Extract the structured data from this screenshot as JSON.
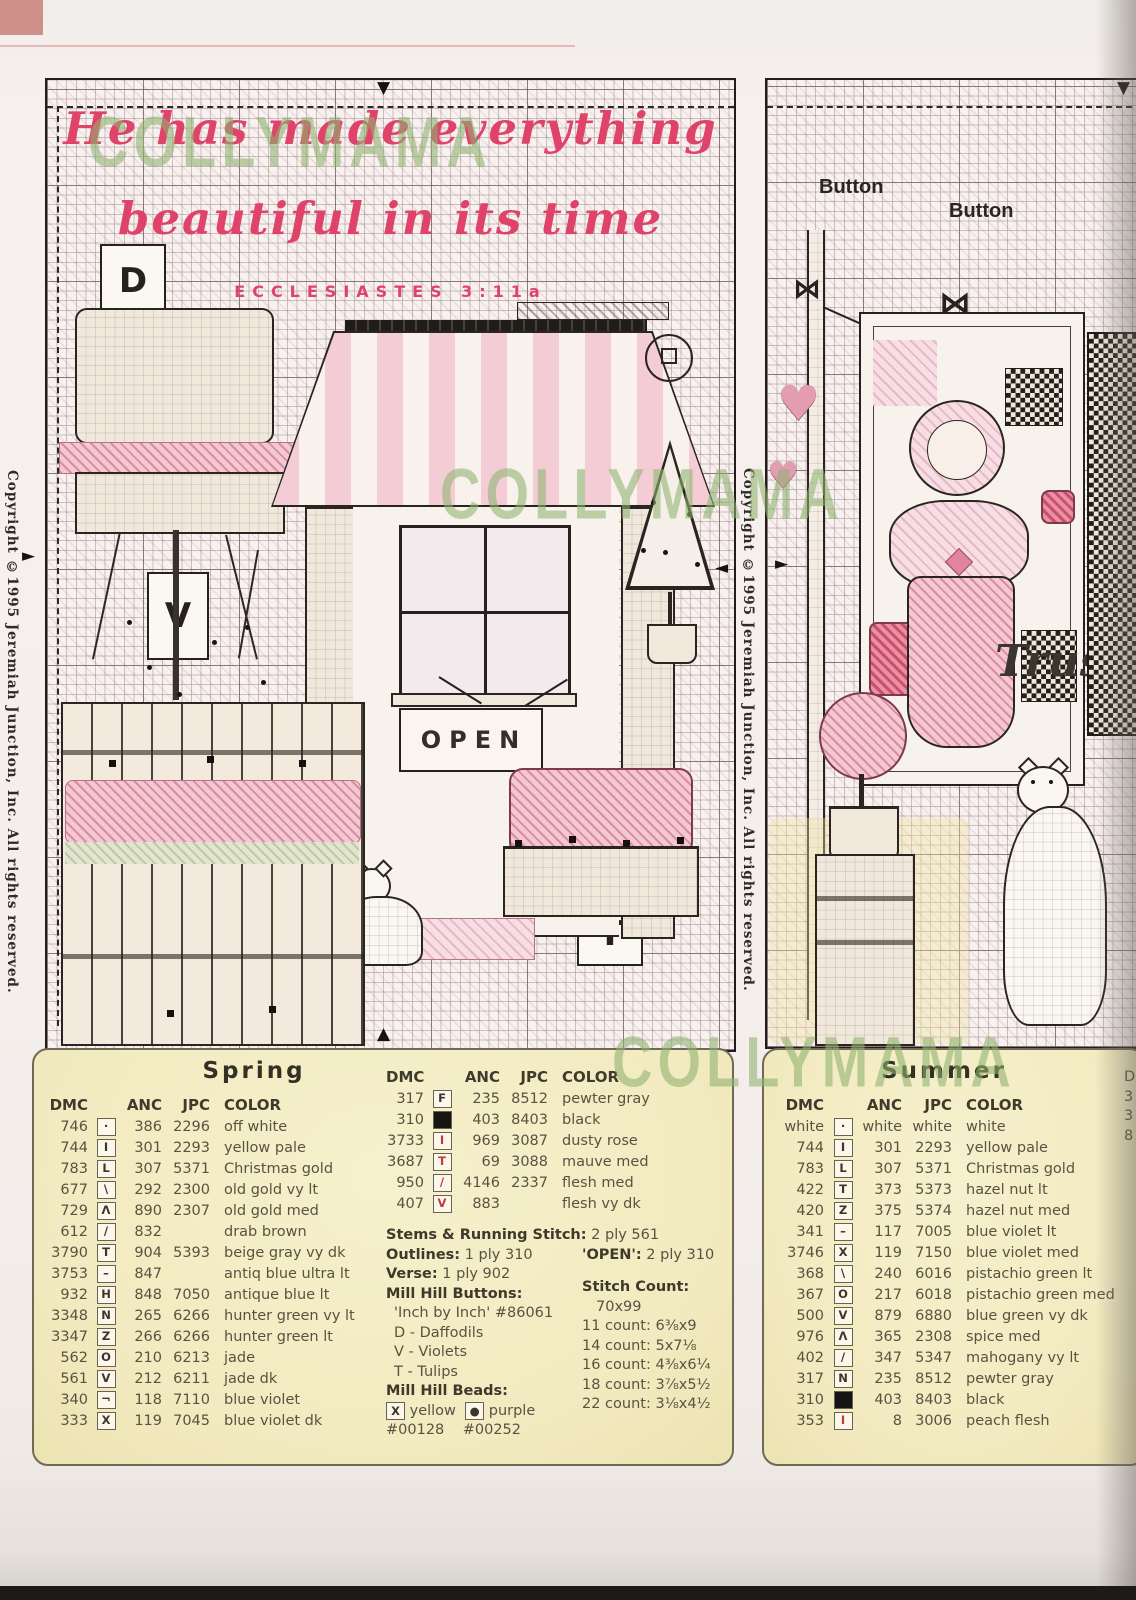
{
  "page": {
    "watermark": "COLLYMAMA",
    "copyright_left": "Copyright ©1995 Jeremiah Junction, Inc. All rights reserved.",
    "copyright_right": "Copyright ©1995 Jeremiah Junction, Inc. All rights reserved."
  },
  "left_chart": {
    "verse_line1": "He has made everything",
    "verse_line2": "beautiful in its time",
    "verse_ref": "ECCLESIASTES 3:11a",
    "open_sign": "OPEN",
    "label_d": "D",
    "label_v": "V",
    "label_t": "T"
  },
  "right_chart": {
    "button1": "Button",
    "button2": "Button",
    "script_text": "Trus"
  },
  "legend_spring": {
    "title": "Spring",
    "headers": [
      "DMC",
      "ANC",
      "JPC",
      "COLOR"
    ],
    "rows": [
      {
        "dmc": "746",
        "sym": "·",
        "style": "plain",
        "anc": "386",
        "jpc": "2296",
        "color": "off white"
      },
      {
        "dmc": "744",
        "sym": "I",
        "style": "plain",
        "anc": "301",
        "jpc": "2293",
        "color": "yellow pale"
      },
      {
        "dmc": "783",
        "sym": "L",
        "style": "plain",
        "anc": "307",
        "jpc": "5371",
        "color": "Christmas gold"
      },
      {
        "dmc": "677",
        "sym": "\\",
        "style": "plain",
        "anc": "292",
        "jpc": "2300",
        "color": "old gold vy lt"
      },
      {
        "dmc": "729",
        "sym": "Λ",
        "style": "plain",
        "anc": "890",
        "jpc": "2307",
        "color": "old gold med"
      },
      {
        "dmc": "612",
        "sym": "/",
        "style": "plain",
        "anc": "832",
        "jpc": "",
        "color": "drab brown"
      },
      {
        "dmc": "3790",
        "sym": "T",
        "style": "plain",
        "anc": "904",
        "jpc": "5393",
        "color": "beige gray vy dk"
      },
      {
        "dmc": "3753",
        "sym": "–",
        "style": "plain",
        "anc": "847",
        "jpc": "",
        "color": "antiq blue ultra lt"
      },
      {
        "dmc": "932",
        "sym": "H",
        "style": "plain",
        "anc": "848",
        "jpc": "7050",
        "color": "antique blue lt"
      },
      {
        "dmc": "3348",
        "sym": "N",
        "style": "plain",
        "anc": "265",
        "jpc": "6266",
        "color": "hunter green vy lt"
      },
      {
        "dmc": "3347",
        "sym": "Z",
        "style": "plain",
        "anc": "266",
        "jpc": "6266",
        "color": "hunter green lt"
      },
      {
        "dmc": "562",
        "sym": "O",
        "style": "plain",
        "anc": "210",
        "jpc": "6213",
        "color": "jade"
      },
      {
        "dmc": "561",
        "sym": "V",
        "style": "plain",
        "anc": "212",
        "jpc": "6211",
        "color": "jade dk"
      },
      {
        "dmc": "340",
        "sym": "¬",
        "style": "plain",
        "anc": "118",
        "jpc": "7110",
        "color": "blue violet"
      },
      {
        "dmc": "333",
        "sym": "X",
        "style": "plain",
        "anc": "119",
        "jpc": "7045",
        "color": "blue violet dk"
      }
    ]
  },
  "legend_spring_extra": {
    "headers": [
      "DMC",
      "ANC",
      "JPC",
      "COLOR"
    ],
    "rows": [
      {
        "dmc": "317",
        "sym": "F",
        "style": "plain",
        "anc": "235",
        "jpc": "8512",
        "color": "pewter gray"
      },
      {
        "dmc": "310",
        "sym": "",
        "style": "fill",
        "anc": "403",
        "jpc": "8403",
        "color": "black"
      },
      {
        "dmc": "3733",
        "sym": "I",
        "style": "red",
        "anc": "969",
        "jpc": "3087",
        "color": "dusty rose"
      },
      {
        "dmc": "3687",
        "sym": "T",
        "style": "red",
        "anc": "69",
        "jpc": "3088",
        "color": "mauve med"
      },
      {
        "dmc": "950",
        "sym": "/",
        "style": "red",
        "anc": "4146",
        "jpc": "2337",
        "color": "flesh med"
      },
      {
        "dmc": "407",
        "sym": "V",
        "style": "red",
        "anc": "883",
        "jpc": "",
        "color": "flesh vy dk"
      }
    ],
    "notes": {
      "stems_label": "Stems & Running Stitch:",
      "stems_value": "2 ply 561",
      "outlines_label": "Outlines:",
      "outlines_value": "1 ply 310",
      "open_label": "'OPEN':",
      "open_value": "2 ply 310",
      "verse_label": "Verse:",
      "verse_value": "1 ply 902",
      "buttons_label": "Mill Hill Buttons:",
      "buttons_name": "'Inch by Inch' #86061",
      "buttons": [
        "D - Daffodils",
        "V - Violets",
        "T - Tulips"
      ],
      "beads_label": "Mill Hill Beads:",
      "bead1_sym": "X",
      "bead1_name": "yellow",
      "bead2_sym": "●",
      "bead2_name": "purple",
      "bead1_code": "#00128",
      "bead2_code": "#00252",
      "stitch_count_label": "Stitch Count:",
      "stitch_count": "70x99",
      "counts": [
        "11 count: 6⅜x9",
        "14 count: 5x7⅛",
        "16 count: 4⅜x6¼",
        "18 count: 3⅞x5½",
        "22 count: 3⅛x4½"
      ]
    }
  },
  "legend_summer": {
    "title": "Summer",
    "headers": [
      "DMC",
      "ANC",
      "JPC",
      "COLOR"
    ],
    "rows": [
      {
        "dmc": "white",
        "sym": "·",
        "style": "plain",
        "anc": "white",
        "jpc": "white",
        "color": "white"
      },
      {
        "dmc": "744",
        "sym": "I",
        "style": "plain",
        "anc": "301",
        "jpc": "2293",
        "color": "yellow pale"
      },
      {
        "dmc": "783",
        "sym": "L",
        "style": "plain",
        "anc": "307",
        "jpc": "5371",
        "color": "Christmas gold"
      },
      {
        "dmc": "422",
        "sym": "T",
        "style": "plain",
        "anc": "373",
        "jpc": "5373",
        "color": "hazel nut lt"
      },
      {
        "dmc": "420",
        "sym": "Z",
        "style": "plain",
        "anc": "375",
        "jpc": "5374",
        "color": "hazel nut med"
      },
      {
        "dmc": "341",
        "sym": "–",
        "style": "plain",
        "anc": "117",
        "jpc": "7005",
        "color": "blue violet lt"
      },
      {
        "dmc": "3746",
        "sym": "X",
        "style": "plain",
        "anc": "119",
        "jpc": "7150",
        "color": "blue violet med"
      },
      {
        "dmc": "368",
        "sym": "\\",
        "style": "plain",
        "anc": "240",
        "jpc": "6016",
        "color": "pistachio green lt"
      },
      {
        "dmc": "367",
        "sym": "O",
        "style": "plain",
        "anc": "217",
        "jpc": "6018",
        "color": "pistachio green med"
      },
      {
        "dmc": "500",
        "sym": "V",
        "style": "plain",
        "anc": "879",
        "jpc": "6880",
        "color": "blue green vy dk"
      },
      {
        "dmc": "976",
        "sym": "Λ",
        "style": "plain",
        "anc": "365",
        "jpc": "2308",
        "color": "spice med"
      },
      {
        "dmc": "402",
        "sym": "/",
        "style": "plain",
        "anc": "347",
        "jpc": "5347",
        "color": "mahogany vy lt"
      },
      {
        "dmc": "317",
        "sym": "N",
        "style": "plain",
        "anc": "235",
        "jpc": "8512",
        "color": "pewter gray"
      },
      {
        "dmc": "310",
        "sym": "",
        "style": "fill",
        "anc": "403",
        "jpc": "8403",
        "color": "black"
      },
      {
        "dmc": "353",
        "sym": "I",
        "style": "red",
        "anc": "8",
        "jpc": "3006",
        "color": "peach flesh"
      }
    ],
    "cutoff_chars": [
      "D",
      "3",
      "3",
      "8"
    ]
  }
}
